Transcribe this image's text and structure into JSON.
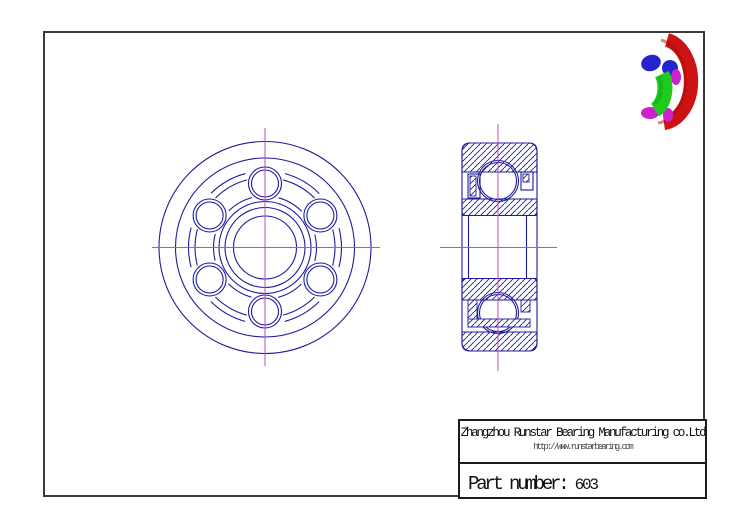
{
  "title_block": {
    "company": "Zhangzhou Runstar Bearing Manufacturing co.Ltd",
    "website": "http://www.runstarbearing.com",
    "part_label": "Part number: ",
    "part_number": "603"
  },
  "drawing": {
    "front_view_ball_count": 6,
    "views": [
      "front view",
      "cross section view",
      "3d cutaway render"
    ]
  },
  "colors": {
    "line": "#1c1c9c",
    "centerline": "#c04ec0",
    "frame": "#3a3a3a",
    "render_red": "#cc1212",
    "render_green": "#1ecc1e",
    "render_blue": "#2424cc",
    "render_magenta": "#cc22cc"
  }
}
